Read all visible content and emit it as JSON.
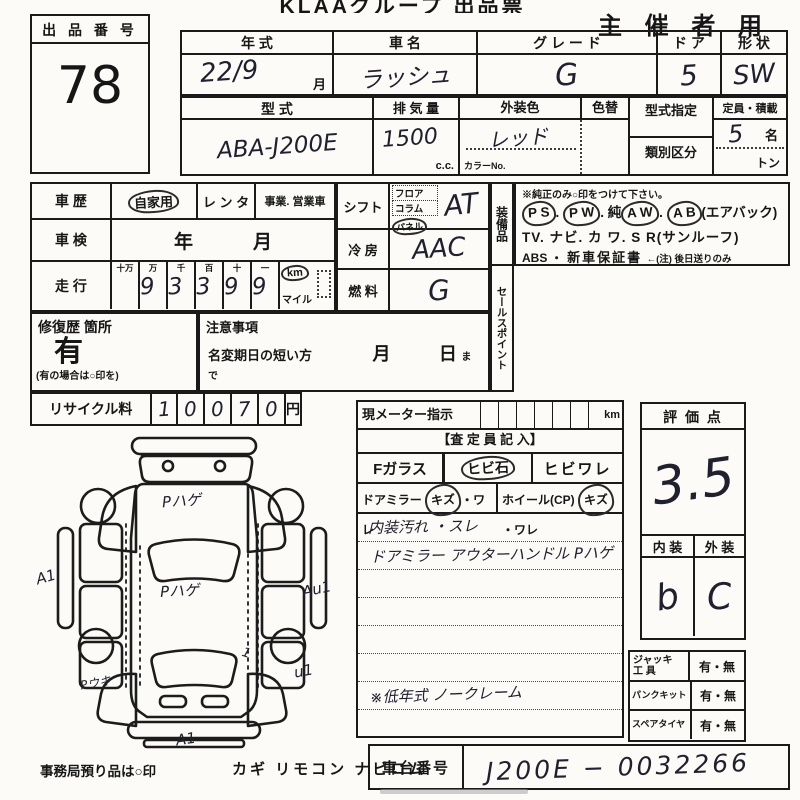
{
  "header": {
    "title": "KLAAグループ 出品票",
    "audience": "主 催 者 用"
  },
  "lot": {
    "label": "出 品 番 号",
    "number": "78"
  },
  "spec": {
    "year": {
      "label": "年   式",
      "value": "22/9",
      "suffix": "月"
    },
    "name": {
      "label": "車   名",
      "value": "ラッシュ"
    },
    "grade": {
      "label": "グ レ ー ド",
      "value": "G"
    },
    "door": {
      "label": "ド ア",
      "value": "5"
    },
    "shape": {
      "label": "形 状",
      "value": "SW"
    },
    "model": {
      "label": "型   式",
      "value": "ABA-J200E"
    },
    "displacement": {
      "label": "排 気 量",
      "value": "1500",
      "unit": "c.c."
    },
    "color": {
      "label": "外装色",
      "value": "レッド",
      "no_label": "カラーNo."
    },
    "repaint": {
      "label": "色替"
    },
    "type_designation": {
      "label": "型式指定"
    },
    "classification": {
      "label": "類別区分"
    },
    "capacity": {
      "label": "定員・積載",
      "value": "5",
      "unit": "名",
      "ton": "トン"
    }
  },
  "history": {
    "label": "車  歴",
    "private": "自家用",
    "rental": "レ ン タ",
    "business": "事業. 営業車"
  },
  "inspection": {
    "label": "車  検",
    "year": "年",
    "month": "月"
  },
  "mileage": {
    "label": "走  行",
    "place_values": [
      "十万",
      "万",
      "千",
      "百",
      "十",
      "一"
    ],
    "digits": [
      "",
      "9",
      "3",
      "3",
      "9",
      "9"
    ],
    "km": "km",
    "mile": "マイル"
  },
  "shift": {
    "label": "シフト",
    "floor": "フロア",
    "column": "コラム",
    "panel": "パネル",
    "value": "AT"
  },
  "aircon": {
    "label": "冷  房",
    "value": "AAC"
  },
  "fuel": {
    "label": "燃  料",
    "value": "G"
  },
  "equipment": {
    "label": "装備品",
    "note": "※純正のみ○印をつけて下さい。",
    "line1": [
      {
        "t": "P S",
        "c": true
      },
      {
        "t": ". "
      },
      {
        "t": "P W",
        "c": true
      },
      {
        "t": ". 純"
      },
      {
        "t": "A W",
        "c": true
      },
      {
        "t": ". "
      },
      {
        "t": "A B",
        "c": true
      },
      {
        "t": "(エアバック)"
      }
    ],
    "line2": "TV. ナビ. カ ワ. S R(サンルーフ)",
    "line3_abs": "ABS ・",
    "line3_warranty": "新車保証書",
    "line3_note": "←(注) 後日送りのみ"
  },
  "sales_point": {
    "label": "セールスポイント"
  },
  "repair": {
    "label": "修復歴 箇所",
    "value": "有",
    "note": "(有の場合は○印を)"
  },
  "caution": {
    "label": "注意事項",
    "name_change": "名変期日の短い方",
    "month": "月",
    "day": "日",
    "made": "まで"
  },
  "recycle": {
    "label": "リサイクル料",
    "digits": [
      "1",
      "0",
      "0",
      "7",
      "0"
    ],
    "unit": "円"
  },
  "meter": {
    "label": "現メーター指示",
    "unit": "km"
  },
  "assessor": {
    "header": "【査 定 員 記 入】",
    "f_glass": "Fガラス",
    "stone_chip": [
      {
        "t": "ヒビ石",
        "c": true
      }
    ],
    "crack": "ヒビワレ",
    "mirror": [
      {
        "t": "ドアミラー "
      },
      {
        "t": "キズ",
        "c": true
      },
      {
        "t": "・ワレ"
      }
    ],
    "wheel": [
      {
        "t": "ホイール(CP) "
      },
      {
        "t": "キズ",
        "c": true
      },
      {
        "t": "・ワレ"
      }
    ]
  },
  "notes": [
    "内装汚れ ・スレ",
    "ドアミラー アウターハンドル Pハゲ",
    "",
    "",
    "",
    "",
    "※低年式 ノークレーム",
    ""
  ],
  "score": {
    "label": "評 価 点",
    "value": "3.5",
    "interior_label": "内 装",
    "exterior_label": "外 装",
    "interior": "b",
    "exterior": "C"
  },
  "tools": {
    "jack_label1": "ジャッキ",
    "jack_label2": "工  具",
    "jack_value": "有・無",
    "puncture_label": "パンクキット",
    "puncture_value": "有・無",
    "spare_label": "スペアタイヤ",
    "spare_value": "有・無"
  },
  "chassis": {
    "label": "車台番号",
    "value": "J200E − 0032266"
  },
  "diagram": {
    "hood": "Pハゲ",
    "roof": "Pハゲ",
    "left": "A1",
    "right": "Au1",
    "left_rear": "Pウキ",
    "right_rear": "u1",
    "rear_tick": "1",
    "bottom": "A1"
  },
  "footer": {
    "deposit": "事務局預り品は○印",
    "items": "カギ リモコン ナビロム"
  }
}
